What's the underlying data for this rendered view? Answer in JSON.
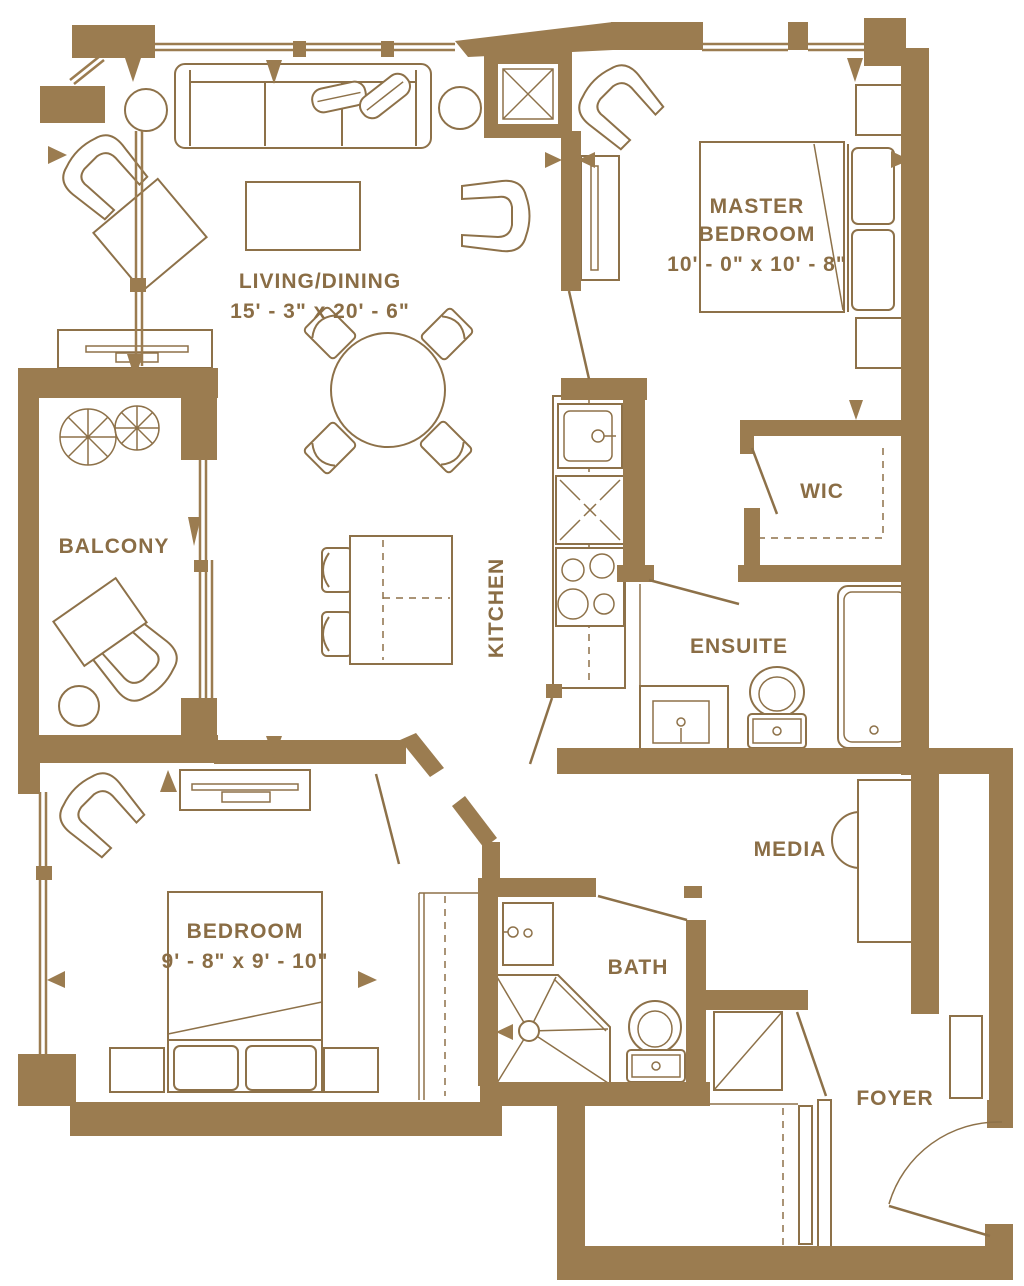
{
  "plan": {
    "colors": {
      "wall": "#9b7c50",
      "furniture_line": "#8d7149",
      "text": "#8a6d45",
      "background": "#ffffff"
    },
    "rooms": {
      "living_dining": {
        "name": "LIVING/DINING",
        "dimensions": "15' - 3\" x 20' - 6\""
      },
      "master_bedroom": {
        "name_line1": "MASTER",
        "name_line2": "BEDROOM",
        "dimensions": "10' - 0\" x 10' - 8\""
      },
      "balcony": {
        "name": "BALCONY"
      },
      "kitchen": {
        "name": "KITCHEN"
      },
      "wic": {
        "name": "WIC"
      },
      "ensuite": {
        "name": "ENSUITE"
      },
      "media": {
        "name": "MEDIA"
      },
      "bedroom": {
        "name": "BEDROOM",
        "dimensions": "9' - 8\" x 9' - 10\""
      },
      "bath": {
        "name": "BATH"
      },
      "foyer": {
        "name": "FOYER"
      }
    }
  }
}
